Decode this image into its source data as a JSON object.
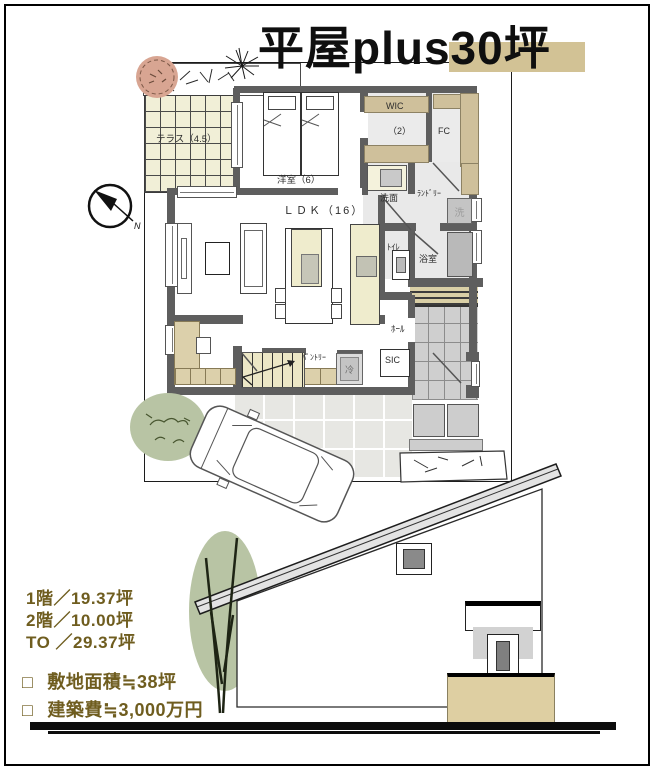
{
  "title": {
    "text": "平屋plus30坪"
  },
  "plan": {
    "compass_label": "N",
    "rooms": {
      "terrace": "テラス（4.5）",
      "bedroom": "洋室（6）",
      "ldk": "ＬＤＫ（16）",
      "wic": "WIC",
      "wic_size": "（2）",
      "fc": "FC",
      "washroom": "洗面",
      "laundry": "ﾗﾝﾄﾞﾘｰ",
      "washer": "洗",
      "toilet": "ﾄｲﾚ",
      "bath": "浴室",
      "hall": "ﾎｰﾙ",
      "sic": "SIC",
      "pantry": "ﾊﾟﾝﾄﾘｰ",
      "fridge": "冷"
    }
  },
  "stats": {
    "floor1": "1階／19.37坪",
    "floor2": "2階／10.00坪",
    "total": "TO ／29.37坪"
  },
  "notes": {
    "bullet": "□",
    "site": "敷地面積≒38坪",
    "cost": "建築費≒3,000万円"
  },
  "colors": {
    "accent_highlight": "#d2c295",
    "text_olive": "#6f5d1f",
    "wall_gray": "#5e5e5e",
    "wood_tan": "#cfc09b",
    "foliage_green": "#b8c4a4",
    "tree_pink": "#d8a592",
    "elevation_base_tan": "#decfa2"
  }
}
